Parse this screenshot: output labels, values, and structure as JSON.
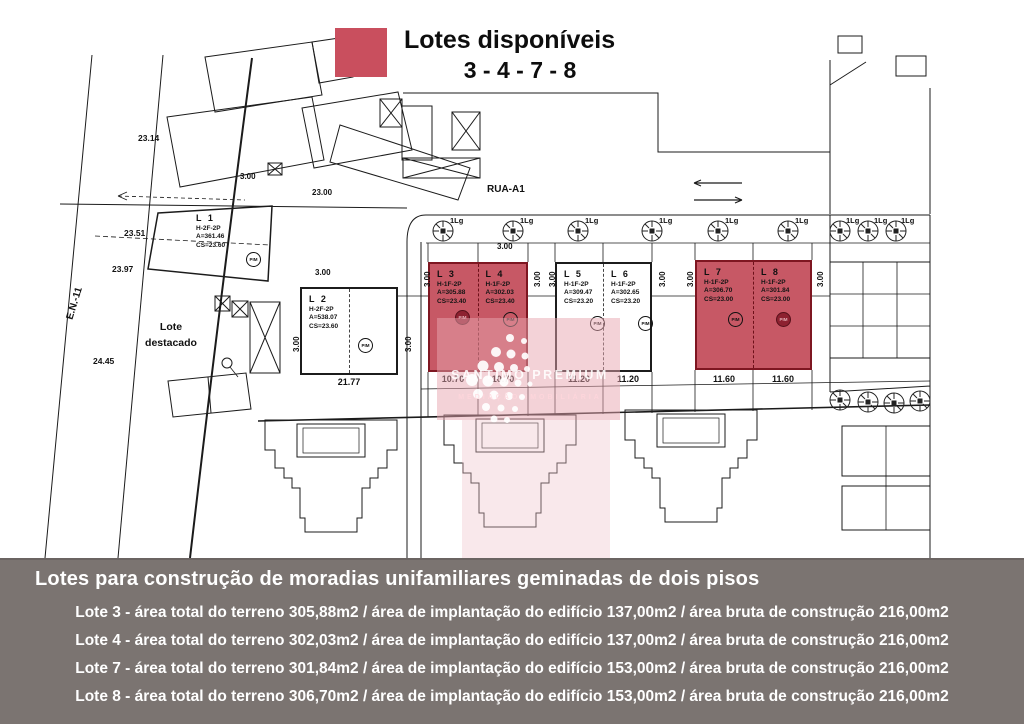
{
  "legend": {
    "title": "Lotes disponíveis",
    "numbers": "3 - 4 - 7 - 8",
    "swatch_color": "#c94f5e"
  },
  "plan": {
    "street_label": "RUA-A1",
    "road_label": "E.N.-11",
    "detached_lot_label": "Lote destacado",
    "tree_label": "1Lg",
    "pim_label": "PIM",
    "elevations": [
      "23.14",
      "23.51",
      "23.97",
      "24.45"
    ],
    "dims": {
      "three": "3.00",
      "twentythree": "23.00"
    },
    "highlight_color": "#c75865",
    "lots": [
      {
        "id": "L 1",
        "type": "H-2F-2P",
        "area": "A=361.46",
        "cs": "CS=23.60",
        "width": "",
        "highlighted": false
      },
      {
        "id": "L 2",
        "type": "H-2F-2P",
        "area": "A=538.07",
        "cs": "CS=23.60",
        "width": "21.77",
        "highlighted": false
      },
      {
        "id": "L 3",
        "type": "H-1F-2P",
        "area": "A=305.88",
        "cs": "CS=23.40",
        "width": "10.70",
        "highlighted": true
      },
      {
        "id": "L 4",
        "type": "H-1F-2P",
        "area": "A=302.03",
        "cs": "CS=23.40",
        "width": "10.70",
        "highlighted": true
      },
      {
        "id": "L 5",
        "type": "H-1F-2P",
        "area": "A=309.47",
        "cs": "CS=23.20",
        "width": "11.20",
        "highlighted": false
      },
      {
        "id": "L 6",
        "type": "H-1F-2P",
        "area": "A=302.65",
        "cs": "CS=23.20",
        "width": "11.20",
        "highlighted": false
      },
      {
        "id": "L 7",
        "type": "H-1F-2P",
        "area": "A=306.70",
        "cs": "CS=23.00",
        "width": "11.60",
        "highlighted": true
      },
      {
        "id": "L 8",
        "type": "H-1F-2P",
        "area": "A=301.84",
        "cs": "CS=23.00",
        "width": "11.60",
        "highlighted": true
      }
    ]
  },
  "watermark": {
    "line1": "SANTIMO PREMIUM",
    "line2": "MEDIAÇÃO IMOBILIÁRIA"
  },
  "footer": {
    "bg_color": "#7b7471",
    "title": "Lotes para construção de moradias unifamiliares geminadas de dois pisos",
    "lines": [
      "Lote 3 - área total do terreno 305,88m2 / área de implantação do edifício 137,00m2 / área bruta de construção 216,00m2",
      "Lote 4 - área total do terreno 302,03m2 / área de implantação do edifício 137,00m2 / área bruta de construção 216,00m2",
      "Lote 7 - área total do terreno 301,84m2 / área de implantação do edifício 153,00m2 / área bruta de construção 216,00m2",
      "Lote 8 - área total do terreno 306,70m2 / área de implantação do edifício 153,00m2 / área bruta de construção 216,00m2"
    ]
  }
}
